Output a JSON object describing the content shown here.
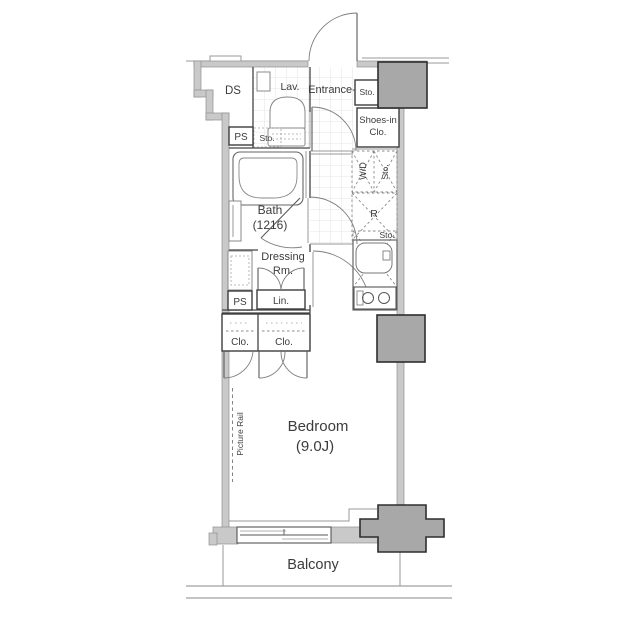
{
  "title": "apartment-floor-plan",
  "palette": {
    "wall_fill": "#c9c9c9",
    "wall_stroke": "#909090",
    "pillar_fill": "#a8a8a8",
    "pillar_stroke": "#2e2e2e",
    "interior_line": "#454545",
    "tile_line": "#dcdcdc",
    "text": "#3c3c3c",
    "background": "#ffffff"
  },
  "labels": {
    "ds": "DS",
    "ps_upper": "PS",
    "lav": "Lav.",
    "lav_sto": "Sto.",
    "entrance": "Entrance-",
    "entrance_sto": "Sto.",
    "shoes_line1": "Shoes-in",
    "shoes_line2": "Clo.",
    "washer_dryer": "W/D",
    "washer_sto": "Sto.",
    "bath_line1": "Bath",
    "bath_line2": "(1216)",
    "fridge": "R",
    "kitchen_sto": "Sto.",
    "dressing_line1": "Dressing",
    "dressing_line2": "Rm.",
    "linen": "Lin.",
    "ps_mid": "PS",
    "closet_left": "Clo.",
    "closet_right": "Clo.",
    "picture_rail": "Picture Rail",
    "bedroom_line1": "Bedroom",
    "bedroom_line2": "(9.0J)",
    "balcony": "Balcony"
  }
}
